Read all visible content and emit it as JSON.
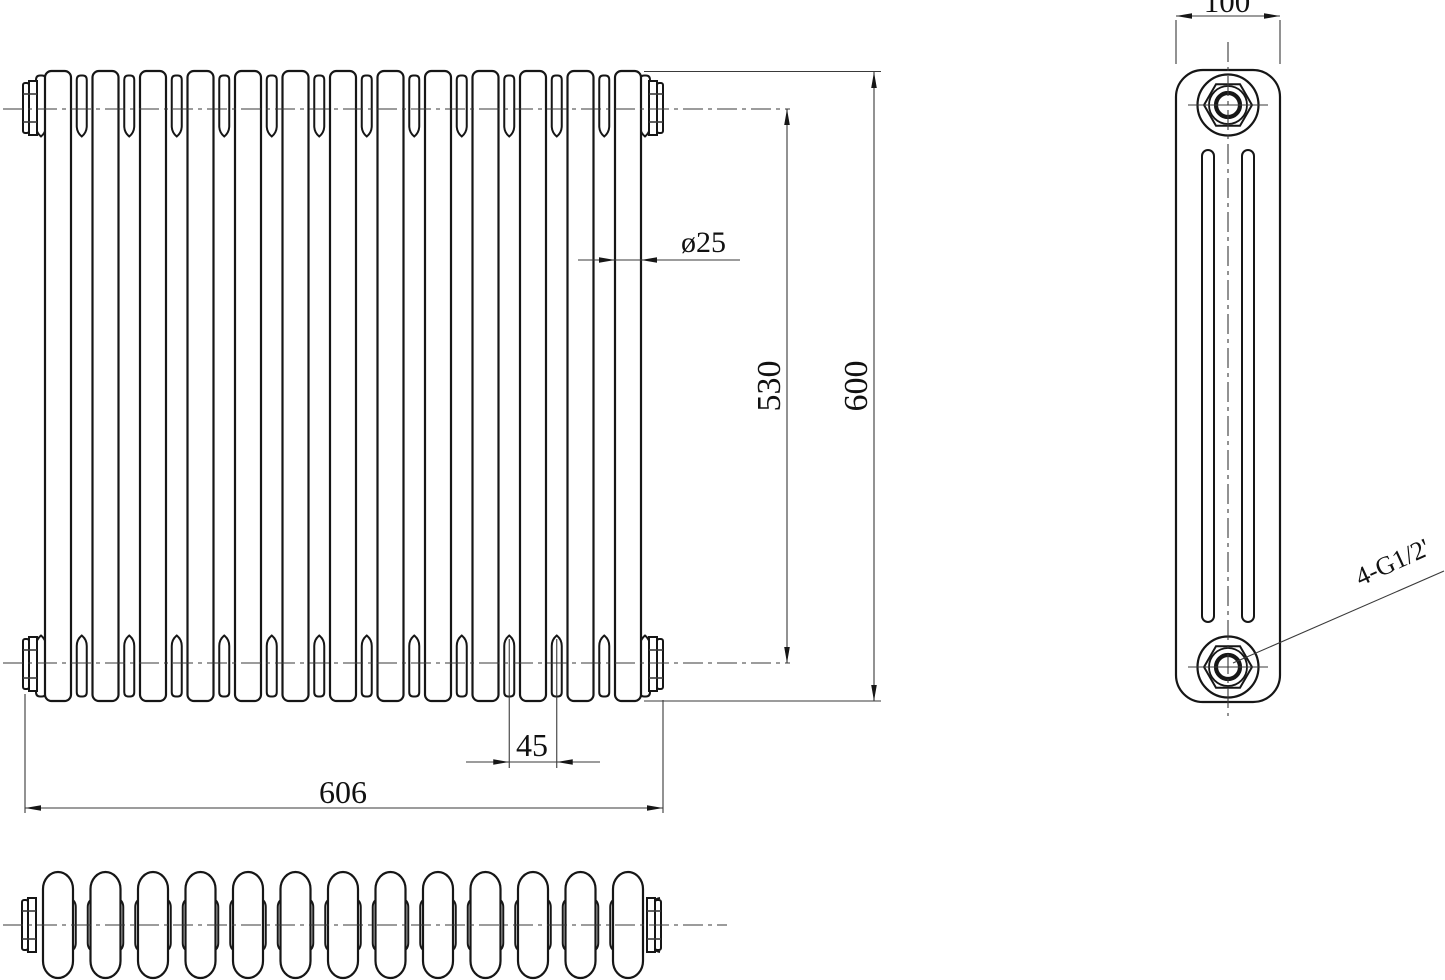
{
  "style": {
    "line_color": "#161616",
    "thin_color": "#3a3a3a",
    "text_color": "#111111",
    "background": "#ffffff"
  },
  "views": {
    "front": {
      "name": "front-view",
      "sections": 13,
      "dim_labels": {
        "tube_diameter": "ø25",
        "center_height": "530",
        "overall_height": "600",
        "section_pitch": "45",
        "overall_width": "606"
      }
    },
    "side": {
      "name": "side-view",
      "slots": 2,
      "plugs": 2,
      "dim_labels": {
        "depth": "100"
      },
      "leader_label": "4-G1/2'"
    },
    "plan": {
      "name": "plan-view",
      "sections": 13
    }
  }
}
